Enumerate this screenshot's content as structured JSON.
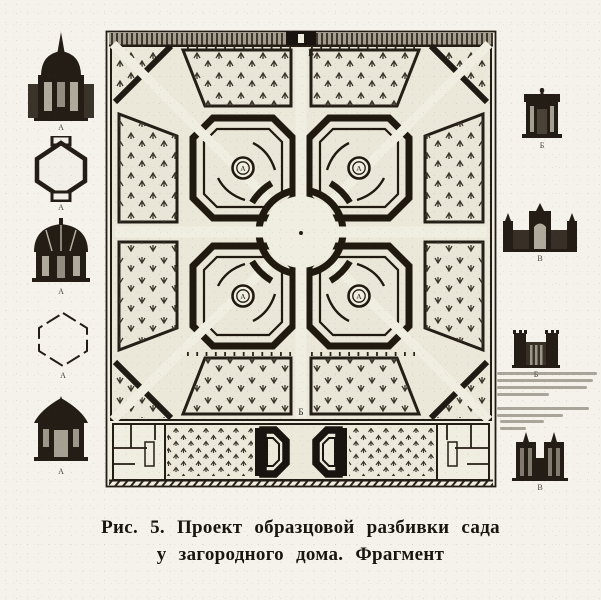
{
  "caption": {
    "line1": "Рис. 5. Проект образцовой разбивки сада",
    "line2": "у загородного дома. Фрагмент"
  },
  "plan": {
    "top_entrance_label": "В",
    "bottom_entrance_label": "Б",
    "medallion_labels": [
      "А",
      "А",
      "А",
      "А"
    ]
  },
  "side_figures": {
    "left": [
      {
        "label": "А"
      },
      {
        "label": "А"
      },
      {
        "label": "А"
      },
      {
        "label": "А"
      },
      {
        "label": "А"
      }
    ],
    "right": [
      {
        "label": "Б"
      },
      {
        "label": "В"
      },
      {
        "label": "Б"
      },
      {
        "label": "В"
      }
    ]
  },
  "colors": {
    "paper": "#f4f2ea",
    "plan_paper": "#ebe8da",
    "ink": "#241d15"
  }
}
